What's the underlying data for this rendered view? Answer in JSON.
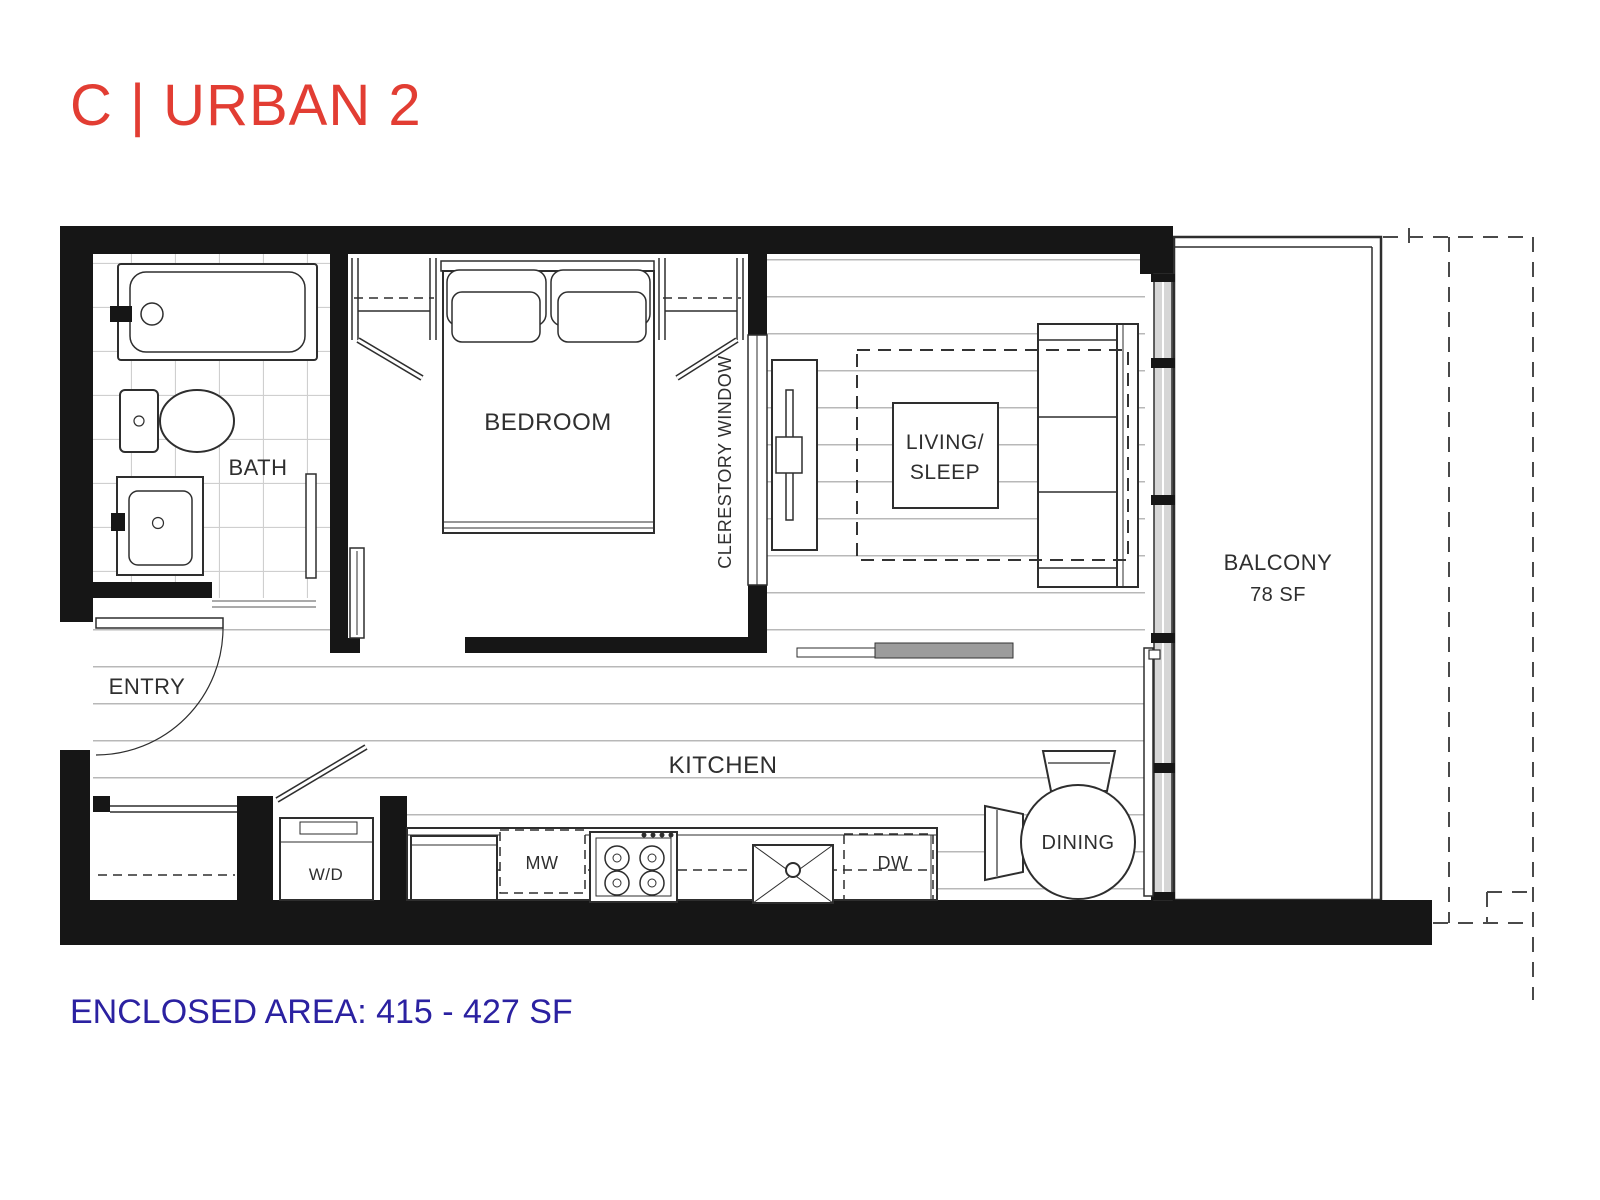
{
  "title": "C | URBAN 2",
  "footer": "ENCLOSED AREA: 415 - 427 SF",
  "colors": {
    "title": "#e23d33",
    "footer": "#2b21a1",
    "wall": "#161616",
    "plank": "#b8b8b8",
    "tile": "#cfcfcf",
    "glass": "#d6d6d6"
  },
  "labels": {
    "bath": "BATH",
    "bedroom": "BEDROOM",
    "entry": "ENTRY",
    "kitchen": "KITCHEN",
    "dining": "DINING",
    "living_line1": "LIVING/",
    "living_line2": "SLEEP",
    "balcony": "BALCONY",
    "balcony_area": "78 SF",
    "clerestory": "CLERESTORY WINDOW",
    "washer_dryer": "W/D",
    "microwave": "MW",
    "dishwasher": "DW"
  }
}
